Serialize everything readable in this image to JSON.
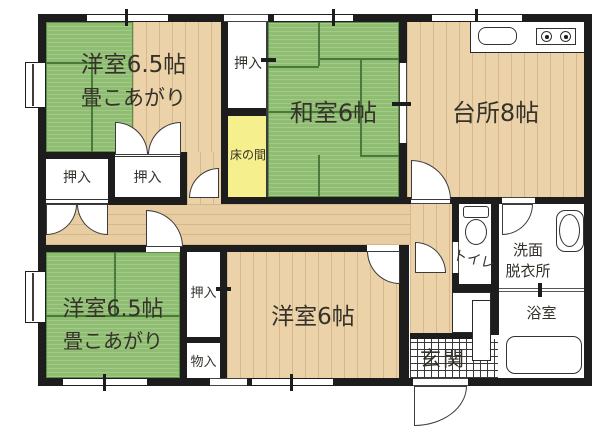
{
  "plan": {
    "title": "floor-plan",
    "colors": {
      "wall": "#1d1d1d",
      "tatami": "#8fbd72",
      "wood": "#ecd2a8",
      "tokonoma": "#f6ef8d",
      "tile_room": "#ffffff"
    },
    "rooms": {
      "western_top": {
        "label": "洋室6.5帖",
        "sublabel": "畳こあがり"
      },
      "washitsu": {
        "label": "和室6帖"
      },
      "kitchen": {
        "label": "台所8帖"
      },
      "western_bottom_left": {
        "label": "洋室6.5帖",
        "sublabel": "畳こあがり"
      },
      "western_bottom": {
        "label": "洋室6帖"
      },
      "toilet": {
        "label": "トイレ"
      },
      "washroom": {
        "line1": "洗面",
        "line2": "脱衣所"
      },
      "bath": {
        "label": "浴室"
      },
      "genkan": {
        "label": "玄関"
      },
      "tokonoma": {
        "label": "床の間"
      },
      "closet_top": {
        "label": "押入"
      },
      "closet_left": {
        "label": "押入"
      },
      "closet_mid": {
        "label": "押入"
      },
      "closet_bottom": {
        "label": "押入"
      },
      "storage": {
        "label": "物入"
      }
    }
  }
}
